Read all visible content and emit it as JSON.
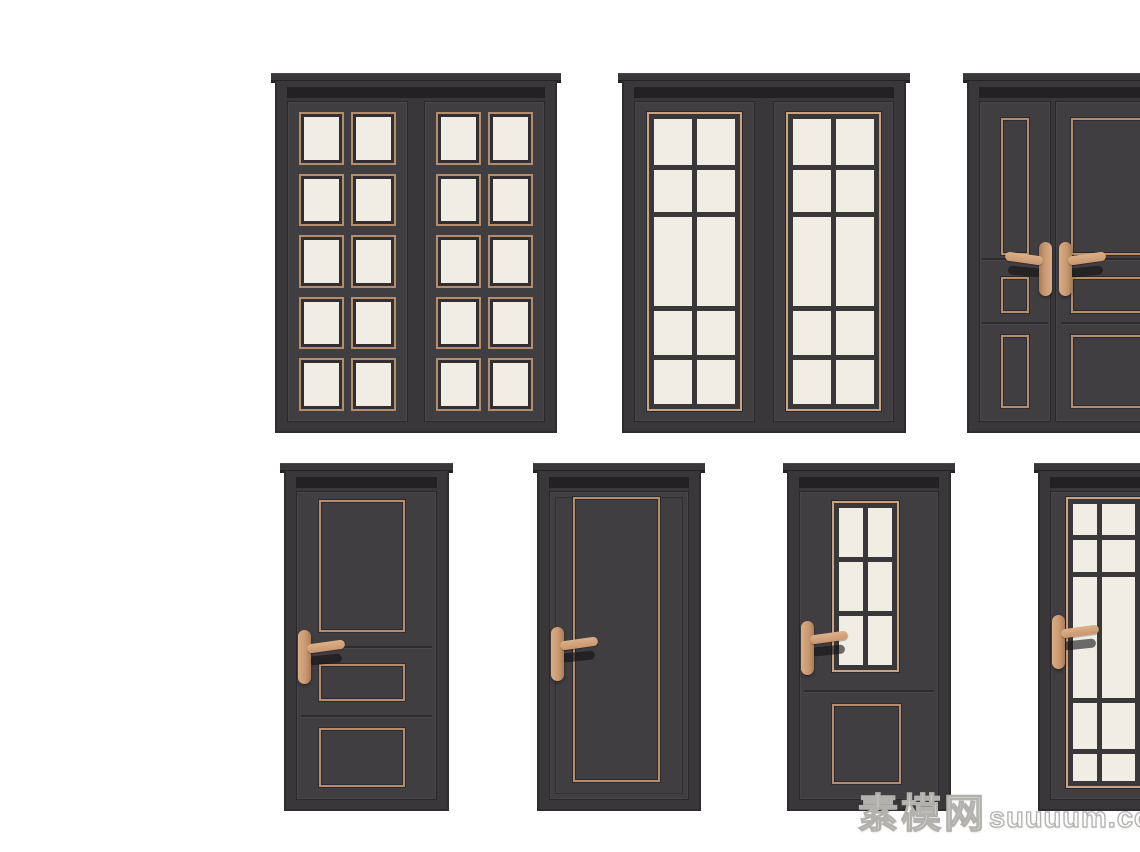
{
  "scene": {
    "description": "Product preview sheet of seven dark charcoal interior door 3D models with copper trim on a white background, two rows (3 double doors on top, 4 single doors below); right-most door in each row is cropped by the image edge",
    "background": "#ffffff"
  },
  "palette": {
    "frame": "#3a373a",
    "frame_edge": "#2f2c2f",
    "leaf": "#413e41",
    "leaf_edge": "#2b282b",
    "reveal": "#232124",
    "copper": "#b48c6e",
    "copper_light": "#c8a283",
    "handle": "#c9976f",
    "cream": "#f0ede5",
    "muntin": "#3a3739",
    "cornice_shadow": "#252226",
    "watermark_outline": "#b3b1ae"
  },
  "watermark": {
    "brand": "素模网",
    "domain": "suuuum.com"
  },
  "doors": [
    {
      "name": "double-door-panel-grid",
      "description": "Double door, each leaf with a 2x5 grid of cream inset panels framed in copper trim",
      "x": 275,
      "y": 73,
      "w": 282,
      "h": 360,
      "kind": "double-panel-grid",
      "leaf_gap": 18,
      "panel_cols": 2,
      "panel_rows": 5
    },
    {
      "name": "double-door-glass-grid",
      "description": "Double glazed door, each leaf a copper-framed cream glass panel with dark muntins, 2 columns x 5 rows with a tall centre row",
      "x": 622,
      "y": 73,
      "w": 284,
      "h": 360,
      "kind": "double-glass-grid",
      "leaf_gap": 20,
      "glass_rows": "1.05fr 0.95fr 2fr 1fr 1fr",
      "glass_cols": "1fr 1fr"
    },
    {
      "name": "double-door-molded-unequal",
      "description": "Unequal double door (narrow leaf + wide leaf) with copper molding outlines and a pair of copper lever handles at the meeting stiles; cropped at right image edge",
      "x": 967,
      "y": 73,
      "w": 285,
      "h": 360,
      "kind": "double-molded",
      "leaf_gap": 6,
      "narrow_leaf_pct": 27,
      "handle_top": "44%",
      "rails": [
        "49%",
        "69%"
      ],
      "narrow_moldings": [
        {
          "l": "30%",
          "t": "5%",
          "w": "40%",
          "h": "43%"
        },
        {
          "l": "30%",
          "t": "55%",
          "w": "40%",
          "h": "11%"
        },
        {
          "l": "30%",
          "t": "73%",
          "w": "40%",
          "h": "23%"
        }
      ],
      "wide_moldings": [
        {
          "l": "8%",
          "t": "5%",
          "w": "86%",
          "h": "43%"
        },
        {
          "l": "8%",
          "t": "55%",
          "w": "86%",
          "h": "11%"
        },
        {
          "l": "8%",
          "t": "73%",
          "w": "86%",
          "h": "23%"
        }
      ]
    },
    {
      "name": "single-door-three-panel",
      "description": "Single door with three copper molding panels (tall top, small middle, bottom) and a left copper lever handle",
      "x": 284,
      "y": 463,
      "w": 165,
      "h": 348,
      "kind": "single",
      "handle_top": "45%",
      "rails": [
        "50%",
        "72.5%"
      ],
      "moldings": [
        {
          "l": "16%",
          "t": "2.5%",
          "w": "62%",
          "h": "43%"
        },
        {
          "l": "16%",
          "t": "56%",
          "w": "62%",
          "h": "12%"
        },
        {
          "l": "16%",
          "t": "77%",
          "w": "62%",
          "h": "19%"
        }
      ]
    },
    {
      "name": "single-door-one-panel",
      "description": "Single door with one tall copper molding outline and a left copper lever handle",
      "x": 537,
      "y": 463,
      "w": 164,
      "h": 348,
      "kind": "single",
      "handle_top": "44%",
      "leaf_edge": true,
      "moldings": [
        {
          "l": "17%",
          "t": "1.5%",
          "w": "63%",
          "h": "93%"
        }
      ]
    },
    {
      "name": "single-door-glass-top",
      "description": "Single door with a copper-framed six-pane window (2x3) above a square copper molding panel, left copper lever handle",
      "x": 787,
      "y": 463,
      "w": 164,
      "h": 348,
      "kind": "single",
      "handle_top": "42%",
      "rails": [
        "64.5%"
      ],
      "window": {
        "l": "23%",
        "t": "3%",
        "w": "49%",
        "h": "55.5%",
        "rows": "1fr 1fr 1fr",
        "cols": "1fr 1fr"
      },
      "moldings": [
        {
          "l": "23%",
          "t": "69%",
          "w": "50%",
          "h": "26%"
        }
      ]
    },
    {
      "name": "single-door-glass-full",
      "description": "Single fully glazed door with copper trim frame and dark muntin grid (3 columns, tall centre row), left copper lever handle; cropped at right image edge",
      "x": 1038,
      "y": 463,
      "w": 165,
      "h": 348,
      "kind": "single",
      "handle_top": "40%",
      "window": {
        "l": "11%",
        "t": "1.5%",
        "w": "82%",
        "h": "95%",
        "rows": "1fr 1fr 3.8fr 1.45fr 0.85fr",
        "cols": "0.75fr 1.05fr 1.05fr"
      }
    }
  ]
}
